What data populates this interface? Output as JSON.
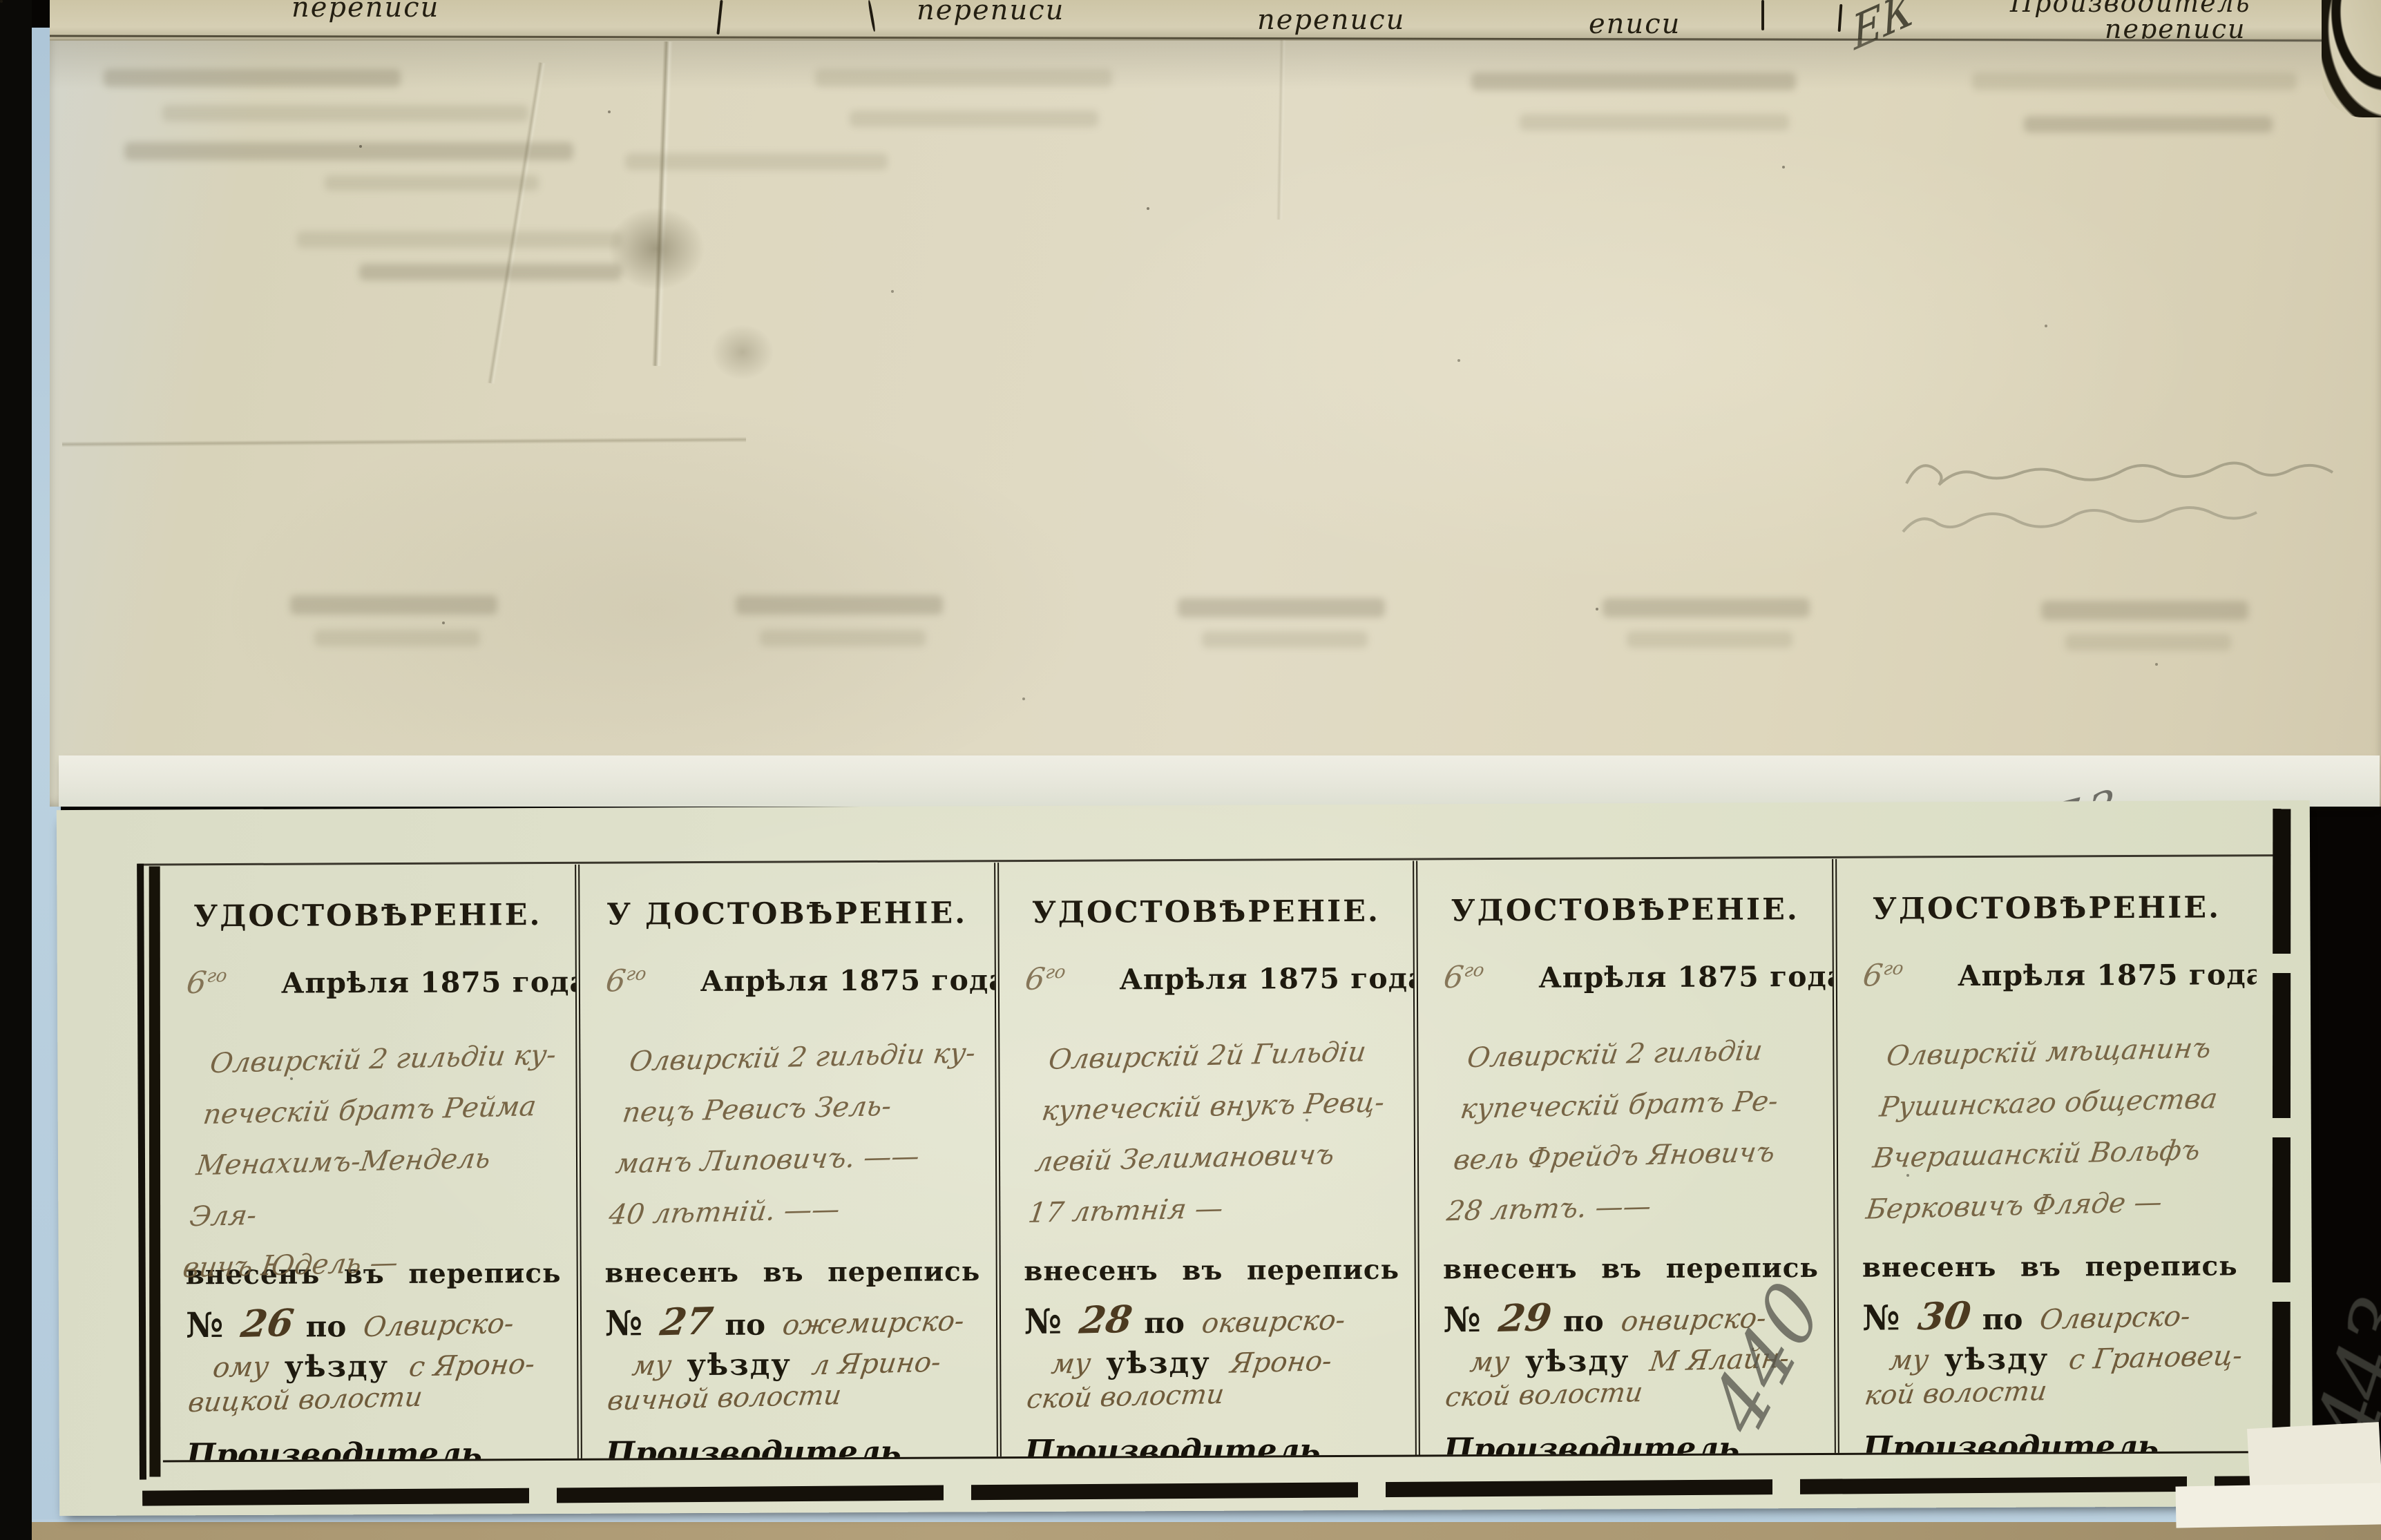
{
  "page": {
    "folio_pencil_number": "773",
    "pencil_mark_lower_1": "440",
    "pencil_mark_lower_2": "443",
    "pencil_flourish_top": "ЕК"
  },
  "prev_page_edge": {
    "fragment_1": "переписи",
    "fragment_2": "переписи",
    "fragment_3": "переписи",
    "fragment_4": "еписи",
    "producer_line1": "Производитель",
    "producer_line2": "переписи"
  },
  "certificates": [
    {
      "header": "УДОСТОВѢРЕНІЕ.",
      "day": "6",
      "day_suffix": "го",
      "date": "Апрѣля 1875 года.",
      "line1": "Олвирскій 2 гильдіи ку-",
      "line2": "печескій братъ Рейма",
      "line3": "Менахимъ-Мендель Эля-",
      "line4": "вичъ Юдель —",
      "entered": "внесенъ въ перепись подъ",
      "no_sign": "№",
      "number": "26",
      "po": "по",
      "uyezd_hw": "Олвирско-",
      "mu_hw": "ому",
      "uyezd_label": "уѣзду",
      "volost_hw1": "с Яроно-",
      "volost_hw2": "вицкой волости",
      "producer1": "Производитель",
      "producer2": "переписи"
    },
    {
      "header": "У ДОСТОВѢРЕНІЕ.",
      "day": "6",
      "day_suffix": "го",
      "date": "Апрѣля 1875 года.",
      "line1": "Олвирскій 2 гильдіи ку-",
      "line2": "пецъ Ревисъ Зель-",
      "line3": "манъ Липовичъ. ——",
      "line4": "40 лѣтній. ——",
      "entered": "внесенъ въ перепись подъ",
      "no_sign": "№",
      "number": "27",
      "po": "по",
      "uyezd_hw": "ожемирско-",
      "mu_hw": "му",
      "uyezd_label": "уѣзду",
      "volost_hw1": "л Ярино-",
      "volost_hw2": "вичной волости",
      "producer1": "Производитель",
      "producer2": "переписи"
    },
    {
      "header": "УДОСТОВѢРЕНІЕ.",
      "day": "6",
      "day_suffix": "го",
      "date": "Апрѣля 1875 года.",
      "line1": "Олвирскій 2й Гильдіи",
      "line2": "купеческій внукъ Ревц-",
      "line3": "левій Зелимановичъ",
      "line4": "17 лѣтнія —",
      "entered": "внесенъ въ перепись подъ",
      "no_sign": "№",
      "number": "28",
      "po": "по",
      "uyezd_hw": "оквирско-",
      "mu_hw": "му",
      "uyezd_label": "уѣзду",
      "volost_hw1": "Яроно-",
      "volost_hw2": "ской волости",
      "producer1": "Производитель",
      "producer2": "переписи"
    },
    {
      "header": "УДОСТОВѢРЕНІЕ.",
      "day": "6",
      "day_suffix": "го",
      "date": "Апрѣля 1875 года.",
      "line1": "Олвирскій 2 гильдіи",
      "line2": "купеческій братъ Ре-",
      "line3": "вель Фрейдъ Яновичъ",
      "line4": "28 лѣтъ. ——",
      "entered": "внесенъ въ перепись подъ",
      "no_sign": "№",
      "number": "29",
      "po": "по",
      "uyezd_hw": "онвирско-",
      "mu_hw": "му",
      "uyezd_label": "уѣзду",
      "volost_hw1": "М Ялайн-",
      "volost_hw2": "ской волости",
      "producer1": "Производитель",
      "producer2": "переписи"
    },
    {
      "header": "УДОСТОВѢРЕНІЕ.",
      "day": "6",
      "day_suffix": "го",
      "date": "Апрѣля 1875 года.",
      "line1": "Олвирскій мѣщанинъ",
      "line2": "Рушинскаго общества",
      "line3": "Вчерашанскій Вольфъ",
      "line4": "Берковичъ Фляде —",
      "entered": "внесенъ въ перепись подъ",
      "no_sign": "№",
      "number": "30",
      "po": "по",
      "uyezd_hw": "Олвирско-",
      "mu_hw": "му",
      "uyezd_label": "уѣзду",
      "volost_hw1": "с Грановец-",
      "volost_hw2": "кой волости",
      "producer1": "Производитель",
      "producer2": "переписи"
    }
  ]
}
